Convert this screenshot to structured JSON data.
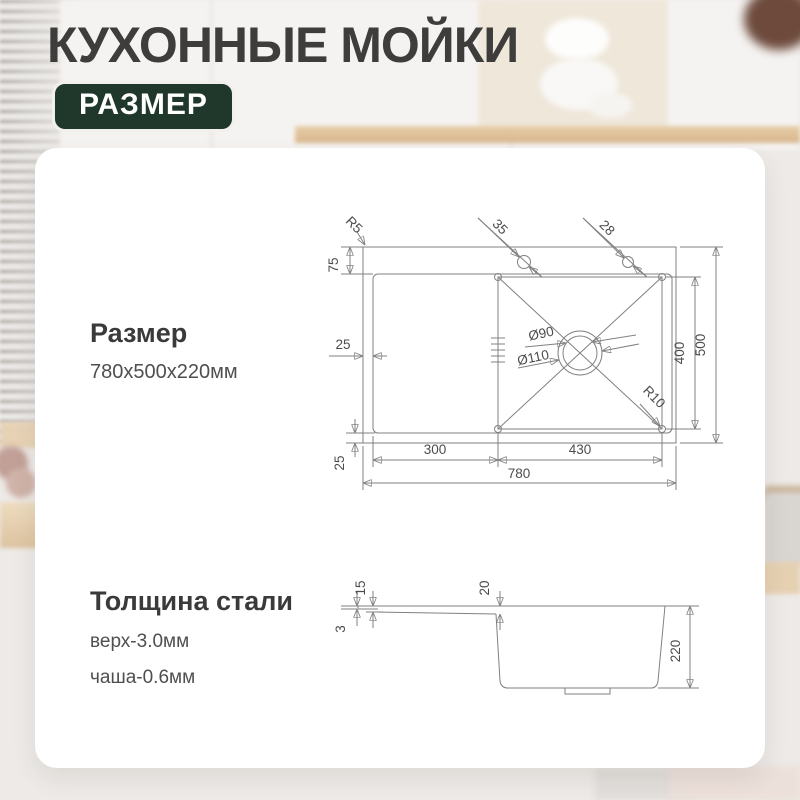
{
  "header": {
    "title": "КУХОННЫЕ МОЙКИ",
    "badge": "РАЗМЕР"
  },
  "card": {
    "size": {
      "heading": "Размер",
      "value": "780x500x220мм"
    },
    "thickness": {
      "heading": "Толщина стали",
      "line1": "верх-3.0мм",
      "line2": "чаша-0.6мм"
    }
  },
  "top_view": {
    "labels": {
      "corner_radius": "R5",
      "deck_depth": "75",
      "hole_left": "35",
      "hole_right": "28",
      "left_inset": "25",
      "bottom_inset": "25",
      "drain_inner": "Ø90",
      "drain_outer": "Ø110",
      "bowl_corner_radius": "R10",
      "drainboard_width": "300",
      "bowl_width": "430",
      "total_width": "780",
      "bowl_depth": "400",
      "total_depth": "500"
    }
  },
  "side_view": {
    "labels": {
      "deck_thickness": "3",
      "rim_height": "15",
      "board_drop": "20",
      "total_height": "220"
    }
  },
  "colors": {
    "badge_bg": "#20382c",
    "badge_text": "#ffffff",
    "title_text": "#3e3d3b",
    "drawing_line": "#818181",
    "dimension_text": "#4c4c4c",
    "card_bg": "#ffffff"
  }
}
